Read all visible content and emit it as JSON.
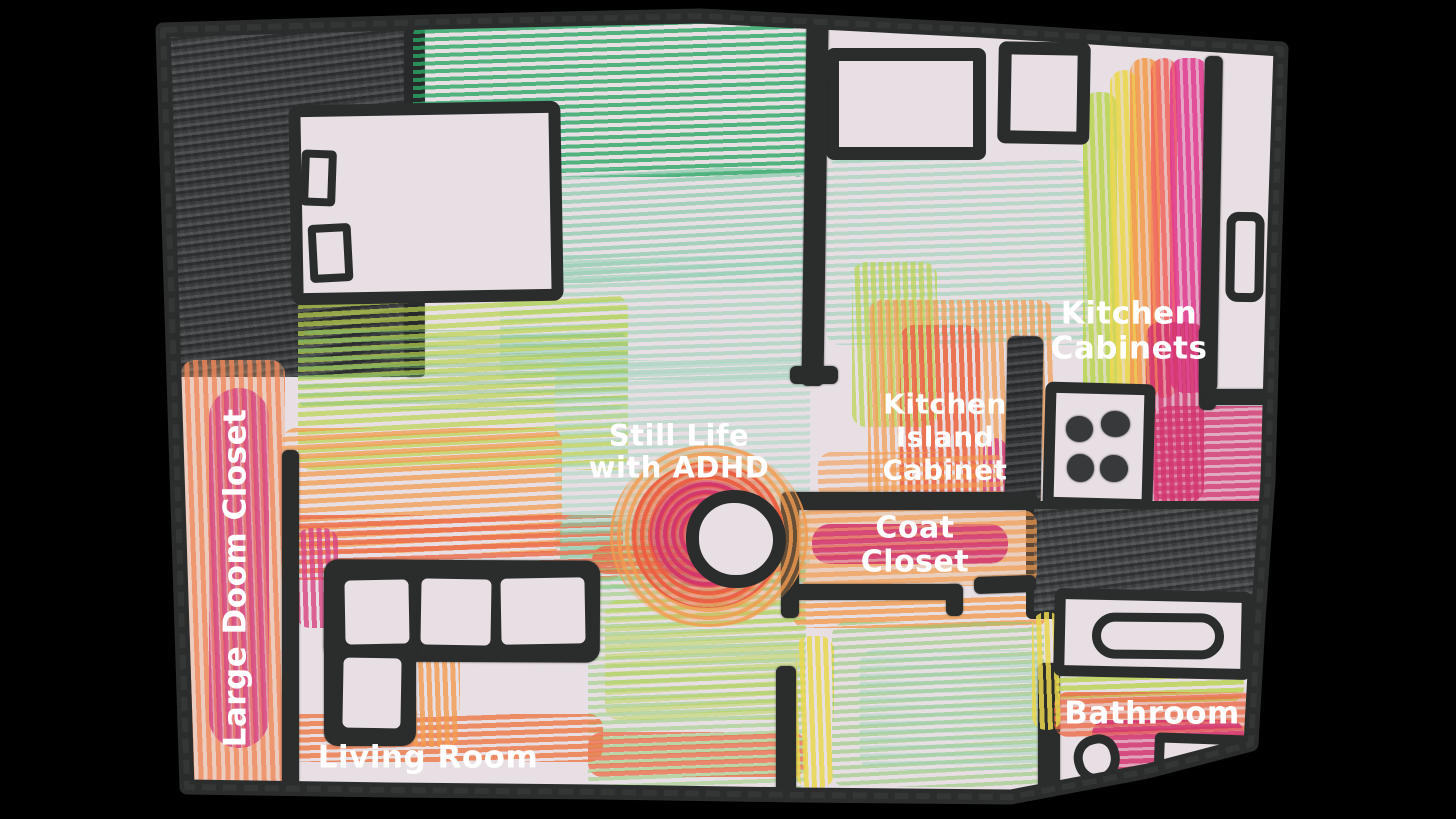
{
  "title": "Hand-drawn crayon floor plan",
  "labels": {
    "large_doom_closet": "Large Doom Closet",
    "still_life": [
      "Still Life",
      "with ADHD"
    ],
    "kitchen_cabinets": [
      "Kitchen",
      "Cabinets"
    ],
    "kitchen_island_cabinet": [
      "Kitchen",
      "Island",
      "Cabinet"
    ],
    "coat_closet": [
      "Coat",
      "Closet"
    ],
    "bathroom": "Bathroom",
    "living_room": "Living Room"
  },
  "palette": {
    "background": "#000000",
    "paper": "#e7dfe3",
    "crayon_black": "#2b2d2d",
    "crayon_dark_gray": "#3e4042",
    "green": "#2aa866",
    "teal_green": "#9ad2b8",
    "yellow_green": "#b9d44d",
    "yellow": "#ead74e",
    "orange": "#f29b4e",
    "red_orange": "#ec6a47",
    "magenta": "#d2336e",
    "pink": "#e0368c",
    "label_text": "#ffffff"
  }
}
